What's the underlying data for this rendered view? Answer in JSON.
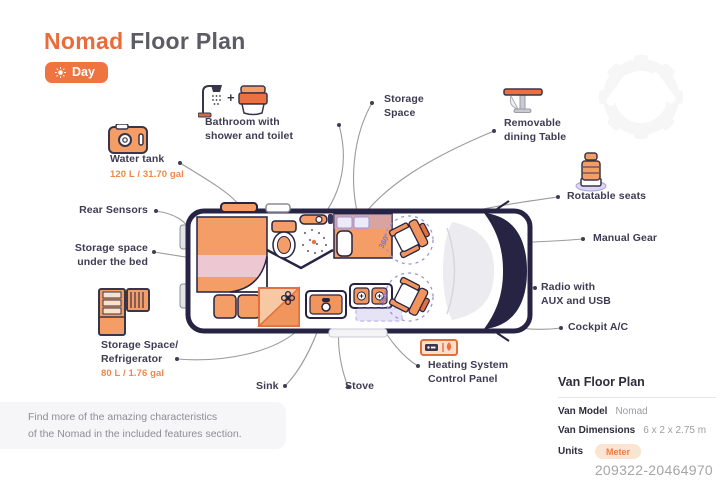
{
  "header": {
    "title_brand": "Nomad",
    "title_rest": "Floor Plan",
    "mode_label": "Day"
  },
  "features": {
    "bathroom": {
      "line1": "Bathroom with",
      "line2": "shower and toilet"
    },
    "storage_space": {
      "line1": "Storage",
      "line2": "Space"
    },
    "removable_table": {
      "line1": "Removable",
      "line2": "dining Table"
    },
    "water_tank": {
      "line1": "Water tank",
      "sub": "120 L / 31.70 gal"
    },
    "rear_sensors": {
      "line1": "Rear Sensors"
    },
    "under_bed": {
      "line1": "Storage space",
      "line2": "under the bed"
    },
    "fridge": {
      "line1": "Storage Space/",
      "line2": "Refrigerator",
      "sub": "80 L / 1.76 gal"
    },
    "sink": {
      "line1": "Sink"
    },
    "stove": {
      "line1": "Stove"
    },
    "heating": {
      "line1": "Heating System",
      "line2": "Control Panel"
    },
    "rotatable_seats": {
      "line1": "Rotatable seats"
    },
    "manual_gear": {
      "line1": "Manual Gear"
    },
    "radio": {
      "line1": "Radio with",
      "line2": "AUX and USB"
    },
    "cockpit_ac": {
      "line1": "Cockpit A/C"
    }
  },
  "van_graphic": {
    "rotation_labels": [
      "360°",
      "360°"
    ]
  },
  "note": {
    "line1": "Find more of the amazing characteristics",
    "line2": "of the Nomad in the included features section."
  },
  "info_panel": {
    "heading": "Van Floor Plan",
    "rows": [
      {
        "label": "Van Model",
        "value": "Nomad"
      },
      {
        "label": "Van Dimensions",
        "value": "6 x 2 x 2.75 m"
      },
      {
        "label": "Units",
        "value": "Meter"
      }
    ]
  },
  "watermark_id": "209322-20464970",
  "colors": {
    "accent": "#EE7040",
    "fill_orange": "#F49D66",
    "navy": "#272343",
    "pink": "#EDC7D1",
    "lavender": "#9C94D6",
    "leader_line": "#9B9B9F"
  }
}
